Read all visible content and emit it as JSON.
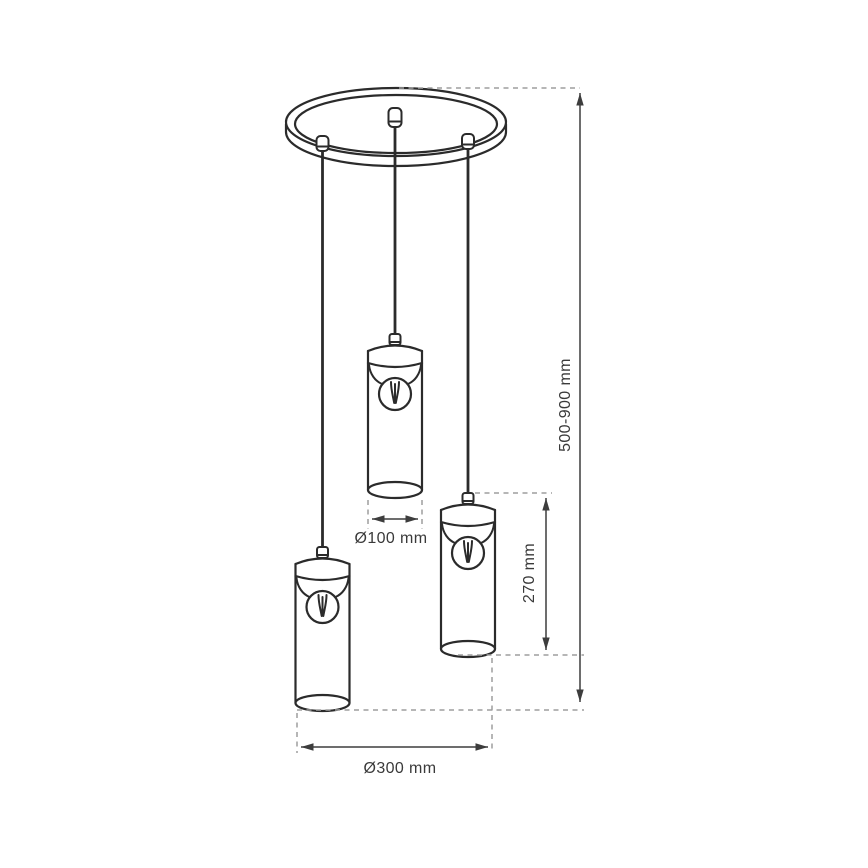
{
  "diagram": {
    "subject": "Three-light cluster pendant lamp: round ceiling canopy with three cord grips and three cylindrical glass shades with bulbs, shown at different drop heights",
    "background_color": "#ffffff",
    "outline_color": "#2b2b2b",
    "dimension_line_color": "#3d3d3d",
    "extension_line_color": "#9d9d9d",
    "text_color": "#3a3a3a",
    "pendant_count": "3",
    "dimensions": {
      "drop_height": {
        "label": "500-900 mm",
        "orientation": "vertical",
        "measures": "overall hanging height from canopy to lowest shade"
      },
      "shade_height": {
        "label": "270 mm",
        "orientation": "vertical",
        "measures": "height of one cylindrical shade"
      },
      "shade_diameter": {
        "label": "Ø100 mm",
        "orientation": "horizontal",
        "measures": "diameter of one cylindrical shade"
      },
      "canopy_diameter": {
        "label": "Ø300 mm",
        "orientation": "horizontal",
        "measures": "overall diameter / footprint of the fixture"
      }
    }
  }
}
